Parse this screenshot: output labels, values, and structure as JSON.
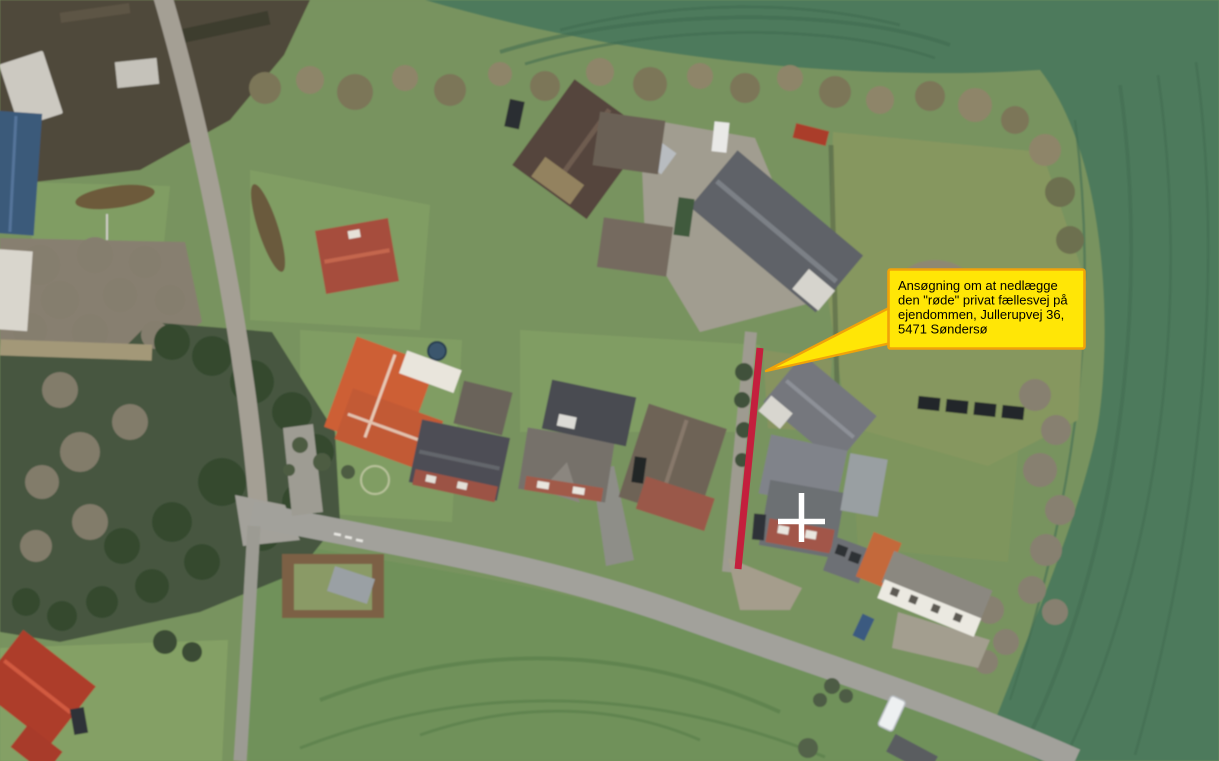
{
  "callout": {
    "lines": [
      "Ansøgning om at nedlægge",
      "den \"røde\" privat fællesvej på",
      "ejendommen, Jullerupvej 36,",
      "5471 Søndersø"
    ],
    "fill": "#ffe606",
    "border": "#f0a30a",
    "text_color": "#000000"
  },
  "markers": {
    "private_road_line": {
      "color": "#c41f3d",
      "x1": 760,
      "y1": 348,
      "x2": 738,
      "y2": 569
    },
    "cross": {
      "color": "#ffffff"
    },
    "arrow": {
      "tip_x": 766,
      "tip_y": 371
    }
  }
}
